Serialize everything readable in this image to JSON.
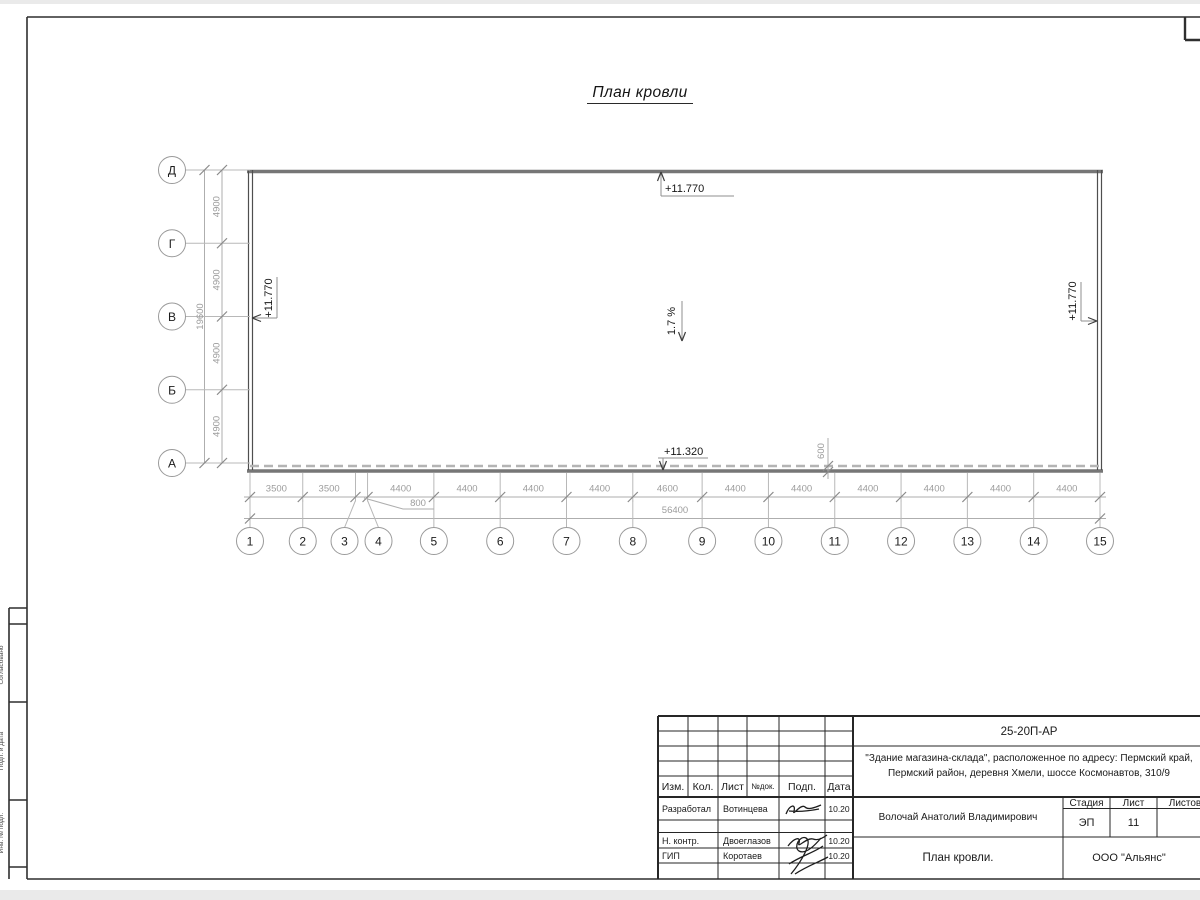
{
  "sheet": {
    "drawing_title": "План кровли",
    "colors": {
      "wall_gray": "#767676",
      "dim_text_gray": "#9c9c9c",
      "frame_black": "#2f2f2f"
    }
  },
  "roof_plan": {
    "row_axes": [
      "Д",
      "Г",
      "В",
      "Б",
      "А"
    ],
    "row_dim_labels": [
      "4900",
      "4900",
      "4900",
      "4900"
    ],
    "row_total_label": "19600",
    "col_axes": [
      "1",
      "2",
      "3",
      "4",
      "5",
      "6",
      "7",
      "8",
      "9",
      "10",
      "11",
      "12",
      "13",
      "14",
      "15"
    ],
    "col_dim_labels": [
      "3500",
      "3500",
      "800",
      "4400",
      "4400",
      "4400",
      "4400",
      "4600",
      "4400",
      "4400",
      "4400",
      "4400",
      "4400",
      "4400"
    ],
    "col_total_label": "56400",
    "elevation_top": "+11.770",
    "elevation_left": "+11.770",
    "elevation_right": "+11.770",
    "elevation_bottom": "+11.320",
    "slope_label": "1.7 %",
    "overhang_dim_label": "600"
  },
  "side_stamp": {
    "labels": [
      "Согласовано",
      "Подп. и дата",
      "Инв. № подл."
    ]
  },
  "title_block": {
    "doc_number": "25-20П-АР",
    "project_line1": "\"Здание магазина-склада\", расположенное по адресу: Пермский край,",
    "project_line2": "Пермский район, деревня Хмели, шоссе Космонавтов, 310/9",
    "header_cells": {
      "izm": "Изм.",
      "kol": "Кол.",
      "list": "Лист",
      "ndok": "№док.",
      "podp": "Подп.",
      "data": "Дата"
    },
    "sig_rows": [
      {
        "role": "Разработал",
        "name": "Вотинцева",
        "date": "10.20"
      },
      {
        "role": "Н. контр.",
        "name": "Двоеглазов",
        "date": "10.20"
      },
      {
        "role": "ГИП",
        "name": "Коротаев",
        "date": "10.20"
      }
    ],
    "approver": "Волочай Анатолий Владимирович",
    "stage_label": "Стадия",
    "sheet_label": "Лист",
    "sheets_label": "Листов",
    "stage_value": "ЭП",
    "sheet_value": "11",
    "drawing_name": "План кровли.",
    "company": "ООО \"Альянс\""
  }
}
